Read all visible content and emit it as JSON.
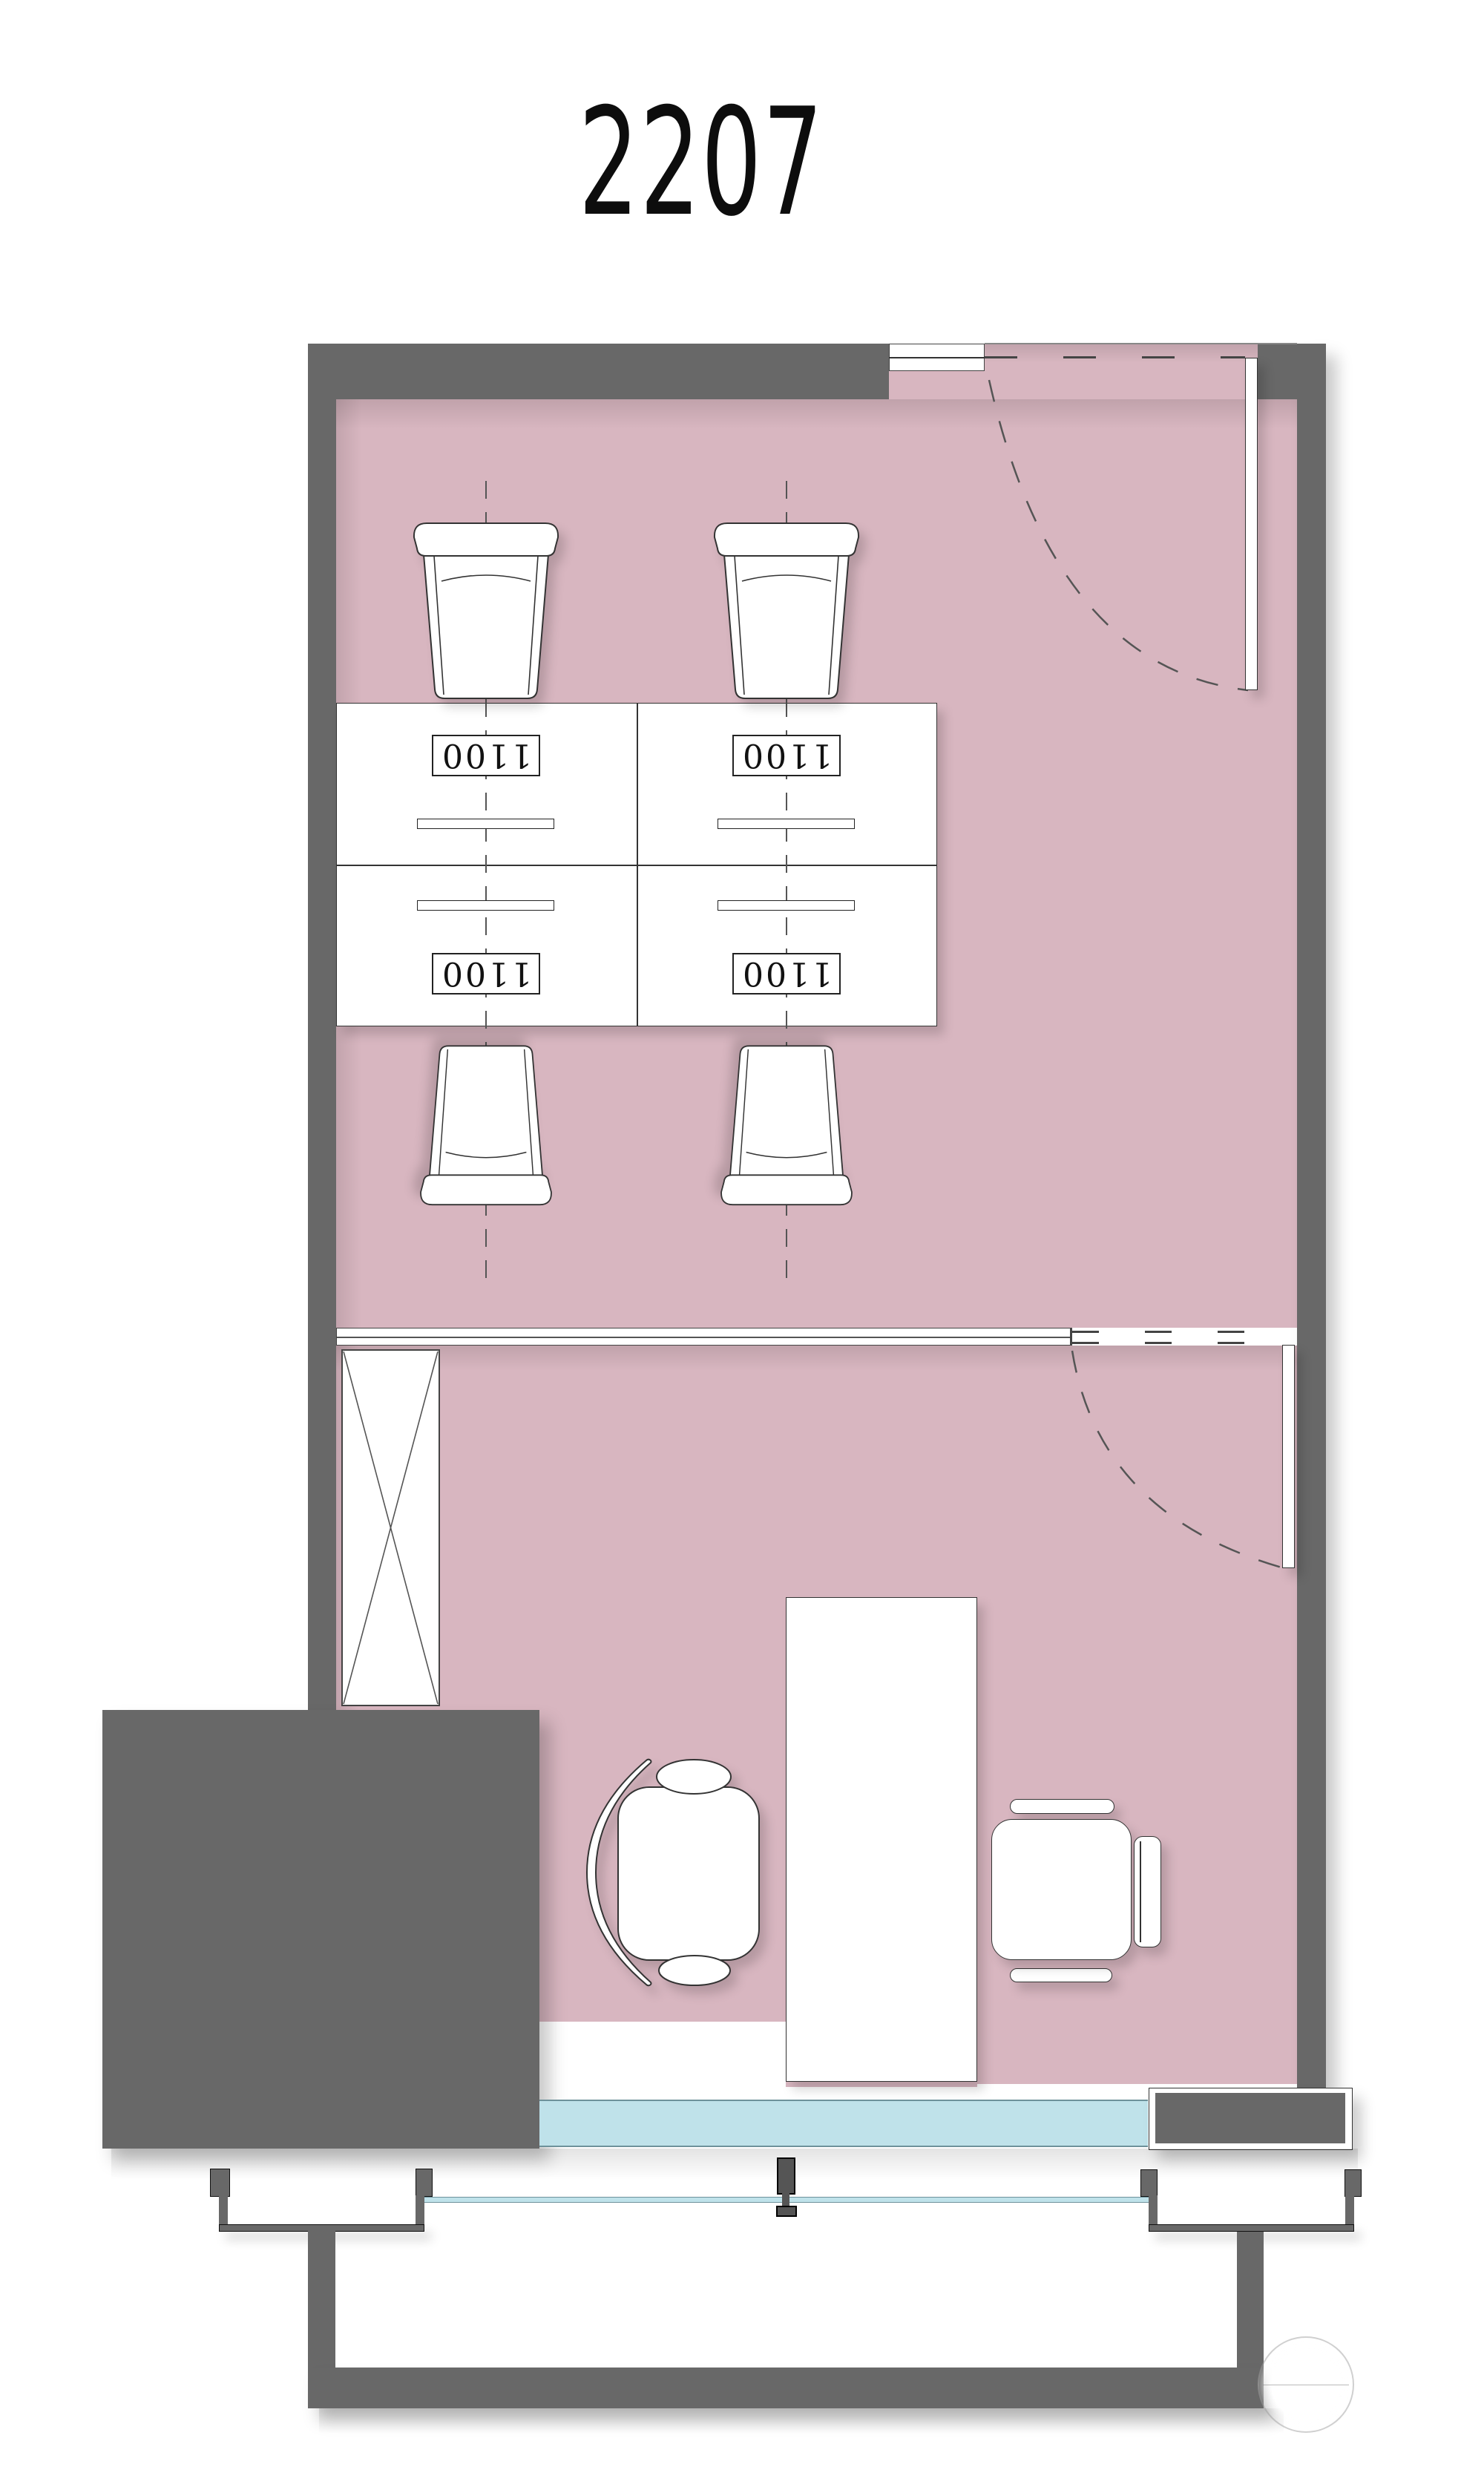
{
  "title": "2207",
  "workstations": {
    "pods": [
      {
        "label": "1100"
      },
      {
        "label": "1100"
      },
      {
        "label": "1100"
      },
      {
        "label": "1100"
      }
    ]
  },
  "colors": {
    "wall": "#686868",
    "floor": "#d8b6c0",
    "glass": "#bfe2ea",
    "glass_edge": "#6e929b",
    "line": "#333333",
    "dash": "#444444"
  }
}
